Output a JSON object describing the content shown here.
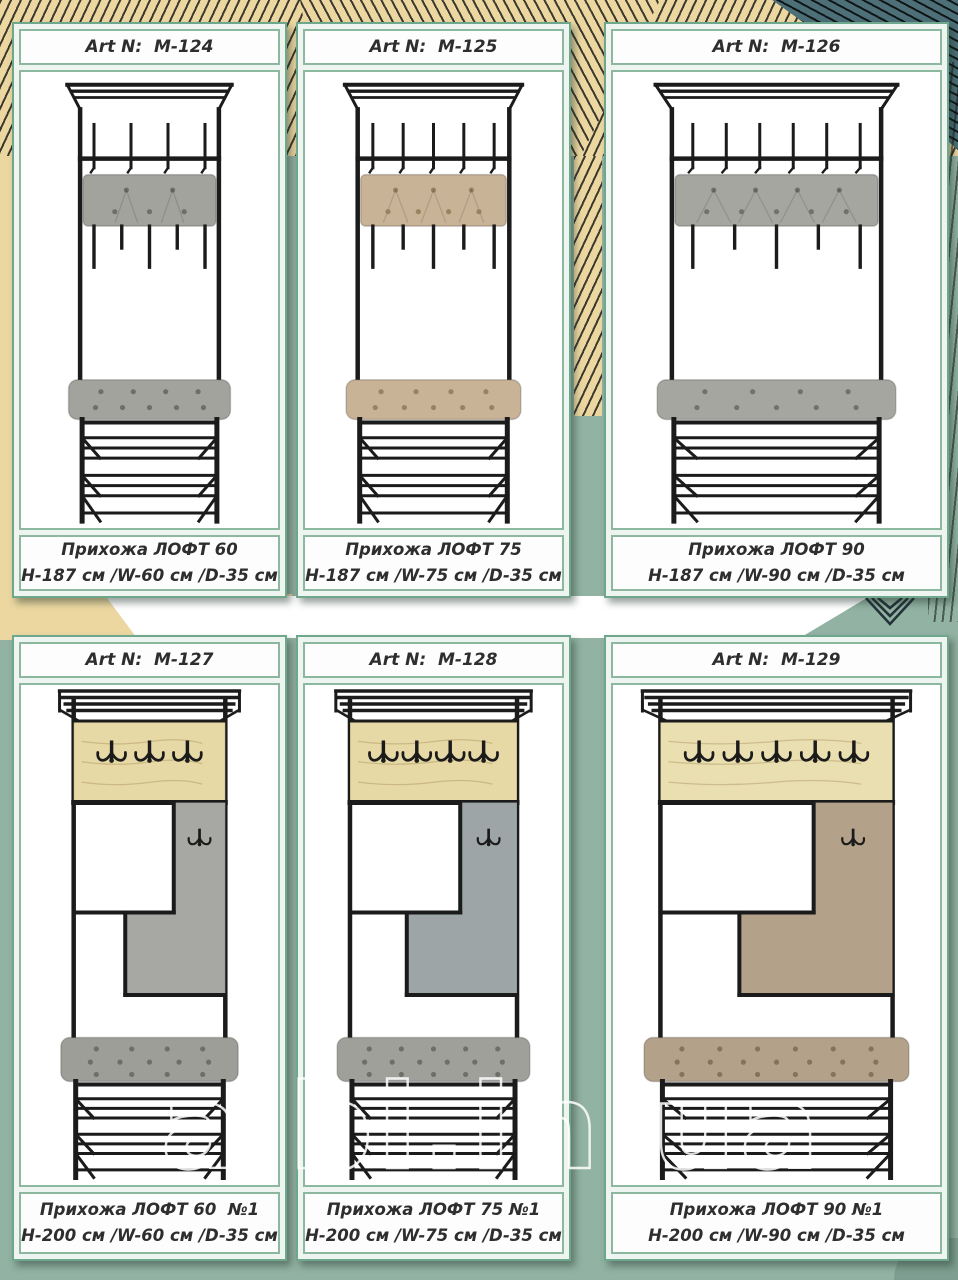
{
  "watermark": "albi.in.ua",
  "background": {
    "sage": "#92b2a3",
    "beige": "#ecd7a1",
    "teal": "#4d6f78",
    "white_band": "#ffffff"
  },
  "cards": [
    {
      "art_label": "Art N:  M-124",
      "title": "Прихожа ЛОФТ 60",
      "dims": "H-187 см /W-60 см /D-35 см",
      "kind": "hooks-rack",
      "hooks": 4,
      "width_cm": 60,
      "colors": {
        "cushion": "#a3a39e",
        "button": "#6f6f6a",
        "bench": "#a3a39e",
        "frame": "#1b1b1b"
      }
    },
    {
      "art_label": "Art N:  M-125",
      "title": "Прихожа ЛОФТ 75",
      "dims": "H-187 см /W-75 см /D-35 см",
      "kind": "hooks-rack",
      "hooks": 5,
      "width_cm": 75,
      "colors": {
        "cushion": "#c9b397",
        "button": "#99825f",
        "bench": "#c9b397",
        "frame": "#1b1b1b"
      }
    },
    {
      "art_label": "Art N:  M-126",
      "title": "Прихожа ЛОФТ 90",
      "dims": "H-187 см /W-90 см /D-35 см",
      "kind": "hooks-rack",
      "hooks": 6,
      "width_cm": 90,
      "colors": {
        "cushion": "#a6a6a1",
        "button": "#72726d",
        "bench": "#a6a6a1",
        "frame": "#1b1b1b"
      }
    },
    {
      "art_label": "Art N:  M-127",
      "title": "Прихожа ЛОФТ 60  №1",
      "dims": "H-200 см /W-60 см /D-35 см",
      "kind": "panel-rack",
      "hooks": 3,
      "width_cm": 60,
      "colors": {
        "wood": "#e7d9a5",
        "felt": "#a7a7a3",
        "bench": "#9e9e99",
        "button": "#6f6f6a",
        "frame": "#1b1b1b"
      }
    },
    {
      "art_label": "Art N:  M-128",
      "title": "Прихожа ЛОФТ 75 №1",
      "dims": "H-200 см /W-75 см /D-35 см",
      "kind": "panel-rack",
      "hooks": 4,
      "width_cm": 75,
      "colors": {
        "wood": "#e7d9a5",
        "felt": "#9da5a6",
        "bench": "#a0a09b",
        "button": "#6f6f6a",
        "frame": "#1b1b1b"
      }
    },
    {
      "art_label": "Art N:  M-129",
      "title": "Прихожа ЛОФТ 90 №1",
      "dims": "H-200 см /W-90 см /D-35 см",
      "kind": "panel-rack",
      "hooks": 5,
      "width_cm": 90,
      "colors": {
        "wood": "#ead fb0",
        "felt": "#b3a289",
        "bench": "#b3a289",
        "button": "#857459",
        "frame": "#1b1b1b"
      }
    }
  ]
}
